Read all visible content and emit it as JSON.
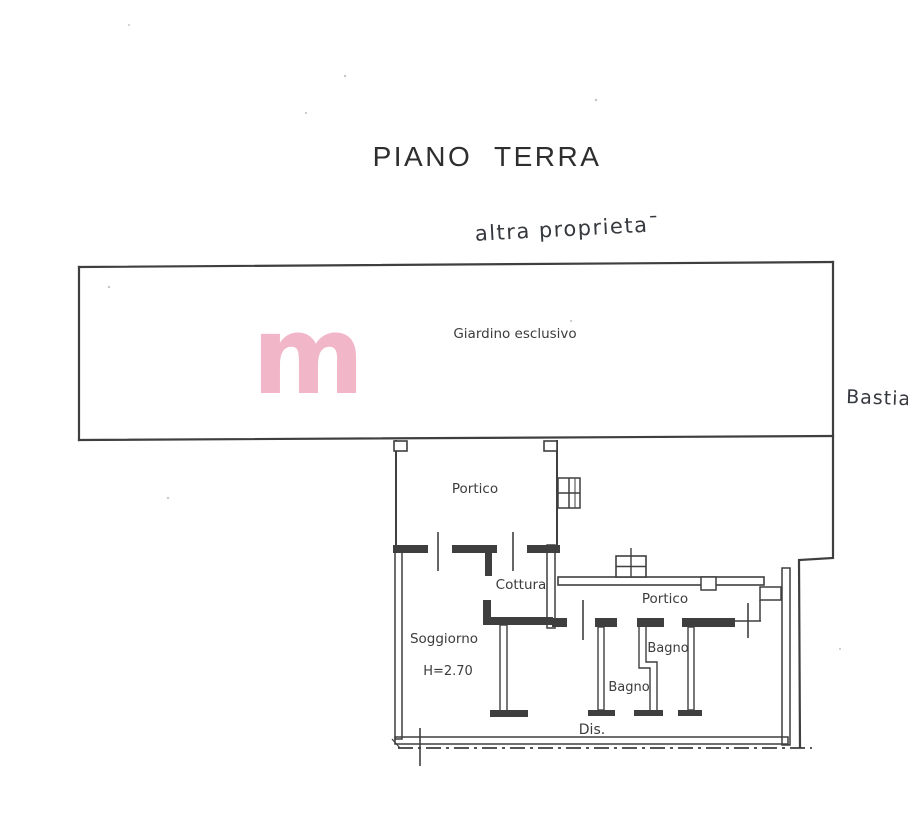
{
  "document": {
    "title": "PIANO TERRA"
  },
  "handwriting": {
    "top_note": "altra proprieta¯",
    "right_note": "Bastia"
  },
  "watermark": {
    "glyph": "m",
    "color": "#f2b6c9"
  },
  "rooms": {
    "giardino": "Giardino esclusivo",
    "portico_upper": "Portico",
    "cottura": "Cottura",
    "soggiorno": "Soggiorno",
    "soggiorno_height": "H=2.70",
    "portico_right": "Portico",
    "bagno_right": "Bagno",
    "bagno_left": "Bagno",
    "dis": "Dis."
  },
  "colors": {
    "ink": "#3f3f3f",
    "paper": "#ffffff"
  }
}
